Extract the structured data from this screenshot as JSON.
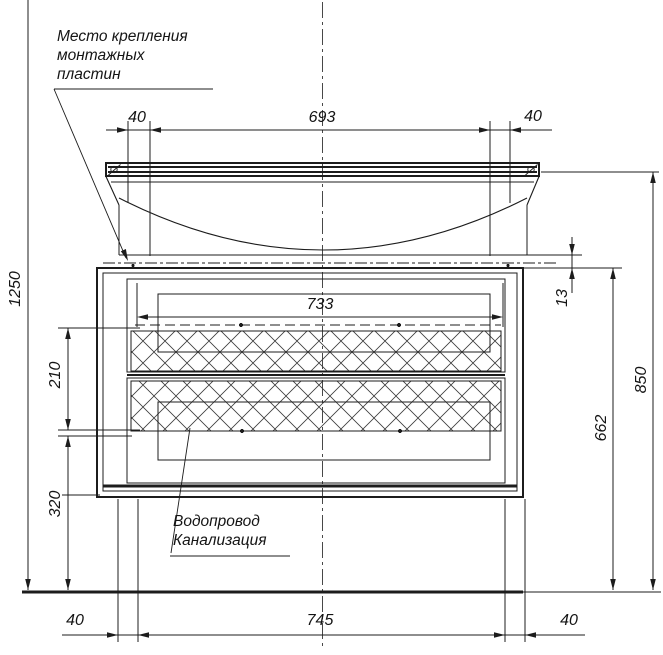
{
  "drawing": {
    "title_type": "furniture washbasin cabinet front elevation",
    "colors": {
      "background": "#ffffff",
      "line": "#1c1c1c",
      "hatch": "#3c3c3c"
    }
  },
  "notes": {
    "mounting": {
      "lines": [
        "Место крепления",
        "монтажных",
        "пластин"
      ]
    },
    "plumbing": {
      "lines": [
        "Водопровод",
        "Канализация"
      ]
    }
  },
  "dims": {
    "top_left_40": "40",
    "top_693": "693",
    "top_right_40": "40",
    "drawer_733": "733",
    "right_13": "13",
    "right_662": "662",
    "right_850": "850",
    "left_1250": "1250",
    "left_210": "210",
    "left_320": "320",
    "bottom_left_40": "40",
    "bottom_745": "745",
    "bottom_right_40": "40"
  }
}
